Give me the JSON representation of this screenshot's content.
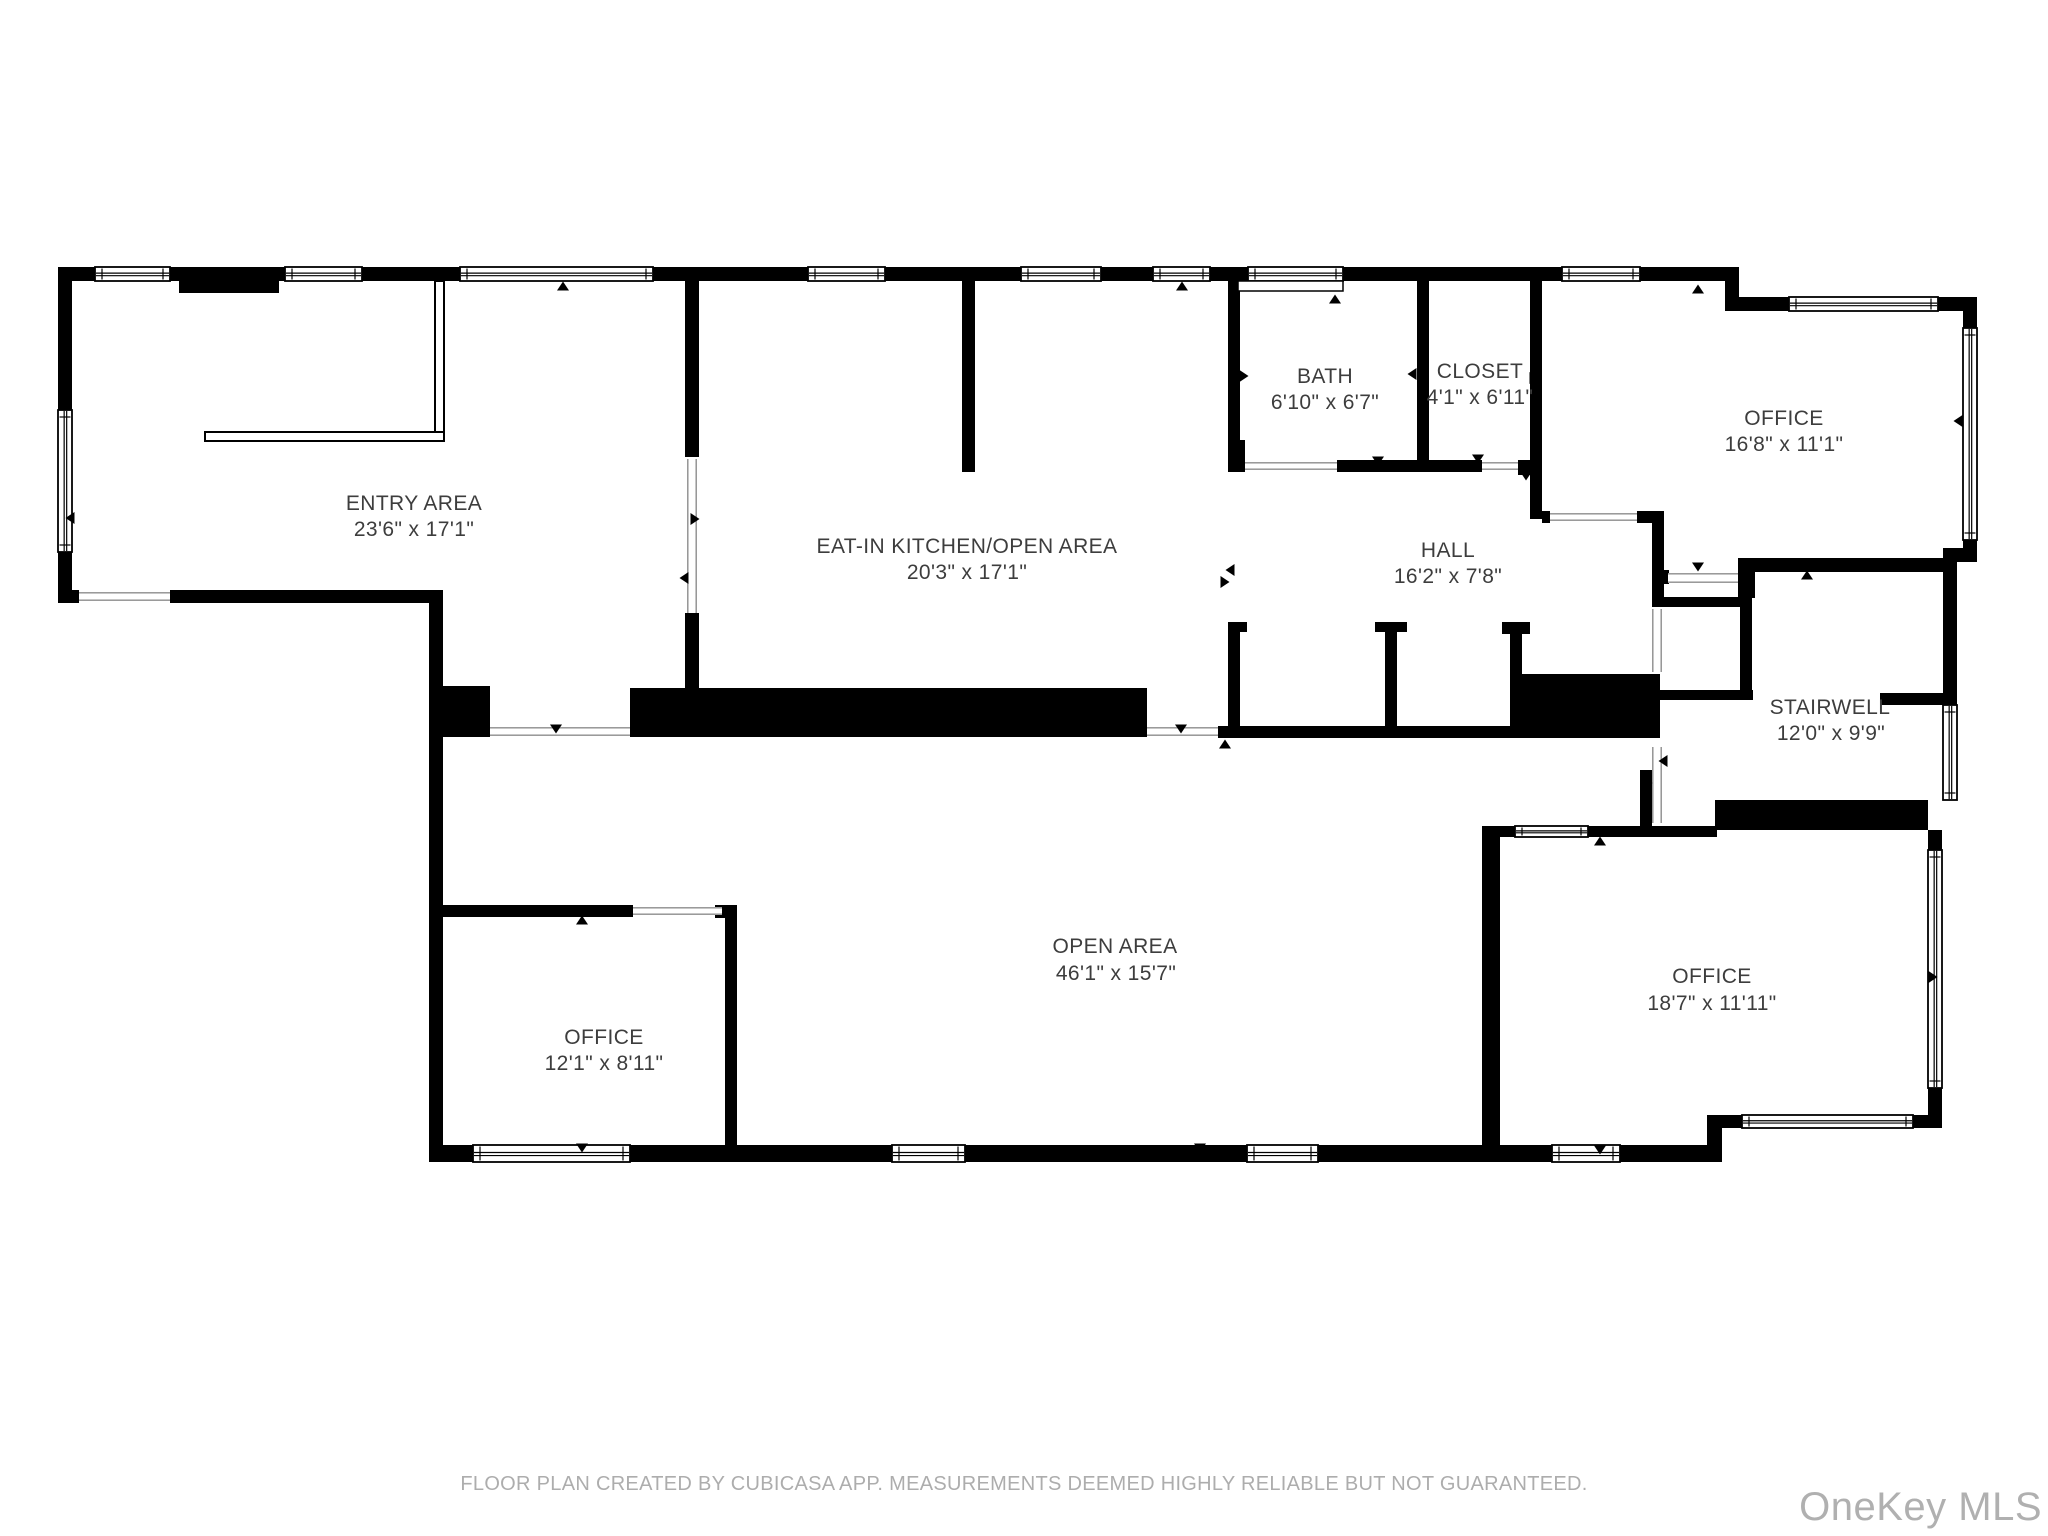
{
  "floor_plan": {
    "rooms": [
      {
        "id": "entry-area",
        "name": "ENTRY AREA",
        "dims": "23'6\" x 17'1\""
      },
      {
        "id": "eat-in-kitchen-open-area",
        "name": "EAT-IN KITCHEN/OPEN AREA",
        "dims": "20'3\" x 17'1\""
      },
      {
        "id": "bath",
        "name": "BATH",
        "dims": "6'10\" x 6'7\""
      },
      {
        "id": "closet",
        "name": "CLOSET",
        "dims": "4'1\" x 6'11\""
      },
      {
        "id": "office-top-right",
        "name": "OFFICE",
        "dims": "16'8\" x 11'1\""
      },
      {
        "id": "hall",
        "name": "HALL",
        "dims": "16'2\" x 7'8\""
      },
      {
        "id": "stairwell",
        "name": "STAIRWELL",
        "dims": "12'0\" x 9'9\""
      },
      {
        "id": "open-area",
        "name": "OPEN AREA",
        "dims": "46'1\" x 15'7\""
      },
      {
        "id": "office-bottom-left",
        "name": "OFFICE",
        "dims": "12'1\" x 8'11\""
      },
      {
        "id": "office-bottom-right",
        "name": "OFFICE",
        "dims": "18'7\" x 11'11\""
      }
    ],
    "footer_note": "FLOOR PLAN CREATED BY CUBICASA APP. MEASUREMENTS DEEMED HIGHLY RELIABLE BUT NOT GUARANTEED.",
    "watermark": "OneKey MLS",
    "colors": {
      "wall": "#000000",
      "background": "#ffffff",
      "room_label": "#3d3d3d",
      "footer_text": "#adadad",
      "watermark_text": "#b0b0b0"
    }
  }
}
